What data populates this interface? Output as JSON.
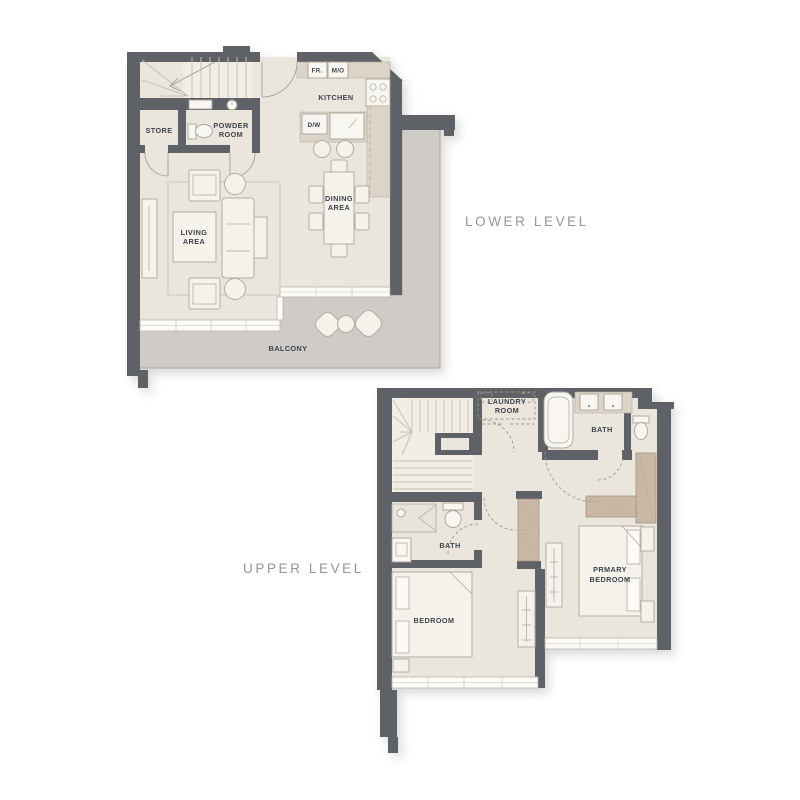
{
  "lower_level": {
    "caption": "LOWER LEVEL",
    "rooms": {
      "store": "STORE",
      "powder": [
        "POWDER",
        "ROOM"
      ],
      "kitchen": "KITCHEN",
      "dining": [
        "DINING",
        "AREA"
      ],
      "living": [
        "LIVING",
        "AREA"
      ],
      "balcony": "BALCONY"
    },
    "appliances": {
      "fridge": "FR.",
      "micro_oven": "M/O",
      "dishwasher": "D/W"
    }
  },
  "upper_level": {
    "caption": "UPPER LEVEL",
    "rooms": {
      "laundry": [
        "LAUNDRY",
        "ROOM"
      ],
      "bath": "BATH",
      "ensuite_bath": "BATH",
      "bedroom": "BEDROOM",
      "primary_bedroom": [
        "PRMARY",
        "BEDROOM"
      ]
    }
  },
  "colors": {
    "wall": "#5e6166",
    "floor": "#eae6de",
    "balcony_floor": "#cfccc7",
    "counter": "#dcd5c7",
    "wardrobe": "#cab7a5",
    "furniture": "#f5f2ec",
    "furniture_outline": "#b2ada2",
    "label": "#3e434b",
    "caption": "#96969a"
  }
}
